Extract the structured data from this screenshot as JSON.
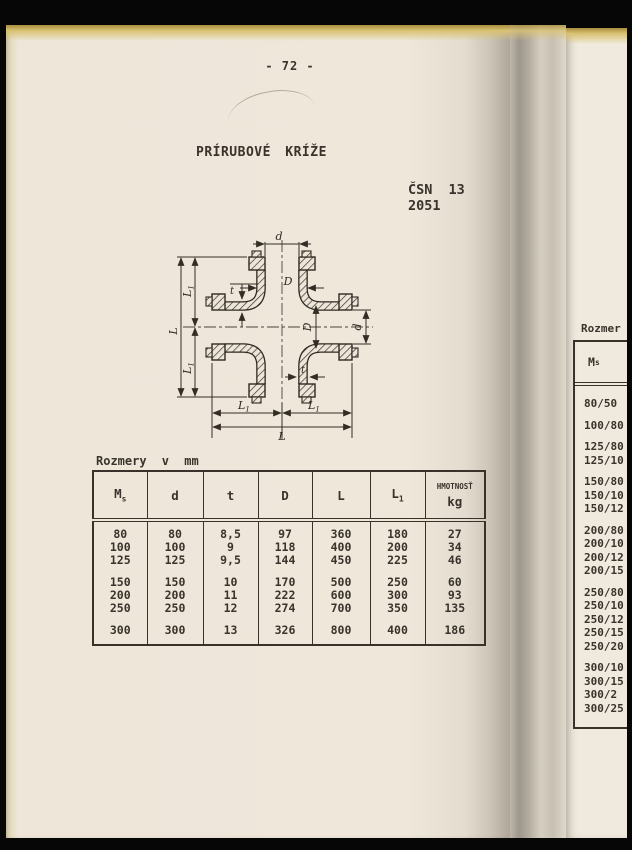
{
  "page": {
    "number_label": "- 72 -",
    "title": "PRÍRUBOVÉ KRÍŽE",
    "standard_code": "ČSN 13 2051"
  },
  "drawing": {
    "labels": {
      "d": "d",
      "D": "D",
      "L": "L",
      "L1_base": "L",
      "L1_sub": "1",
      "t": "t"
    }
  },
  "table": {
    "caption": "Rozmery v mm",
    "headers": [
      {
        "base": "M",
        "sub": "s"
      },
      {
        "base": "d"
      },
      {
        "base": "t"
      },
      {
        "base": "D"
      },
      {
        "base": "L"
      },
      {
        "base": "L",
        "sub": "1"
      },
      {
        "base": "HMOTNOSŤ",
        "second_line": "kg"
      }
    ],
    "groups": [
      [
        [
          "80",
          "80",
          "8,5",
          "97",
          "360",
          "180",
          "27"
        ],
        [
          "100",
          "100",
          "9",
          "118",
          "400",
          "200",
          "34"
        ],
        [
          "125",
          "125",
          "9,5",
          "144",
          "450",
          "225",
          "46"
        ]
      ],
      [
        [
          "150",
          "150",
          "10",
          "170",
          "500",
          "250",
          "60"
        ],
        [
          "200",
          "200",
          "11",
          "222",
          "600",
          "300",
          "93"
        ],
        [
          "250",
          "250",
          "12",
          "274",
          "700",
          "350",
          "135"
        ]
      ],
      [
        [
          "300",
          "300",
          "13",
          "326",
          "800",
          "400",
          "186"
        ]
      ]
    ]
  },
  "adjacent_page": {
    "caption": "Rozmer",
    "header": {
      "base": "M",
      "sub": "s"
    },
    "groups": [
      [
        "80/50"
      ],
      [
        "100/80"
      ],
      [
        "125/80",
        "125/10"
      ],
      [
        "150/80",
        "150/10",
        "150/12"
      ],
      [
        "200/80",
        "200/10",
        "200/12",
        "200/15"
      ],
      [
        "250/80",
        "250/10",
        "250/12",
        "250/15",
        "250/20"
      ],
      [
        "300/10",
        "300/15",
        "300/2",
        "300/25"
      ]
    ]
  },
  "colors": {
    "paper": "#ede6d9",
    "ink": "#3a332c",
    "page_edge_yellow": "#d9c273",
    "surround": "#000000"
  }
}
